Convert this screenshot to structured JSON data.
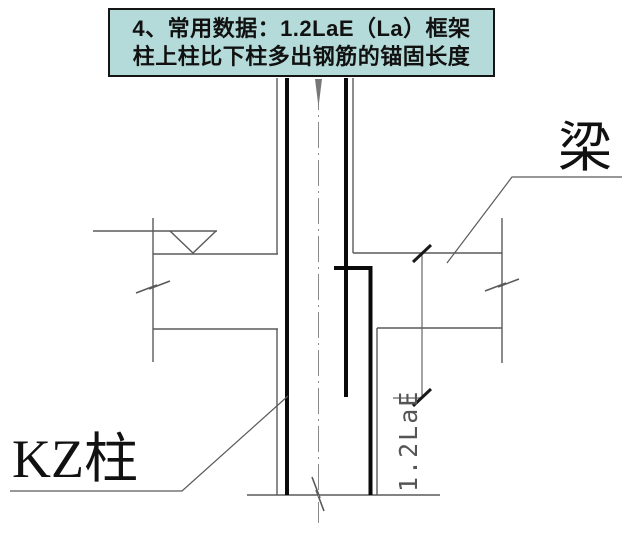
{
  "title": {
    "line1": "4、常用数据：1.2LaE（La）框架",
    "line2": "柱上柱比下柱多出钢筋的锚固长度",
    "background_color": "#b4dbd9",
    "border_color": "#151515",
    "text_color": "#111111"
  },
  "labels": {
    "beam": "梁",
    "column": "KZ柱",
    "dimension": "1.2LaE"
  },
  "drawing": {
    "type": "structural-detail",
    "subject": "frame column joint: anchorage of extra upper-column rebar into lower column",
    "annotations": [
      "梁 (beam) leader at right",
      "KZ柱 (frame column) leader at bottom-left",
      "1.2LaE vertical dimension along lower column"
    ],
    "symbols": [
      "floor-level inverted triangle",
      "beam break marks left and right",
      "column break mark at bottom",
      "column centerline dash-dot with arrow"
    ],
    "colors": {
      "thin_line": "#5a5a5a",
      "rebar_line": "#0a0a0a",
      "dimension_line": "#666666",
      "background": "#ffffff"
    }
  }
}
